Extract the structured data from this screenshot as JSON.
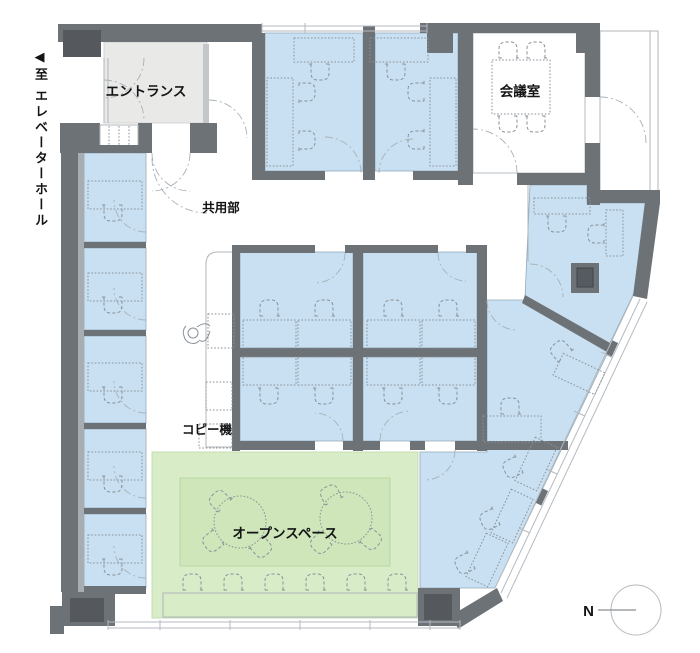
{
  "labels": {
    "elevator_arrow": "◀",
    "elevator_hall": "至 エレベーターホール",
    "entrance": "エントランス",
    "meeting_room": "会議室",
    "common_area": "共用部",
    "copier": "コピー機",
    "open_space": "オープンスペース",
    "compass_north": "N"
  },
  "colors": {
    "wall": "#6d7277",
    "wall_dark": "#55595e",
    "room_blue": "#c8e0f1",
    "open_green": "#d9ecc8",
    "rug_green": "#cee6ba",
    "entrance_gray": "#e9eae8",
    "furniture_line": "#8a929a",
    "door_line": "#a9b1b7",
    "window_line": "#b4bac0",
    "text": "#141414"
  }
}
